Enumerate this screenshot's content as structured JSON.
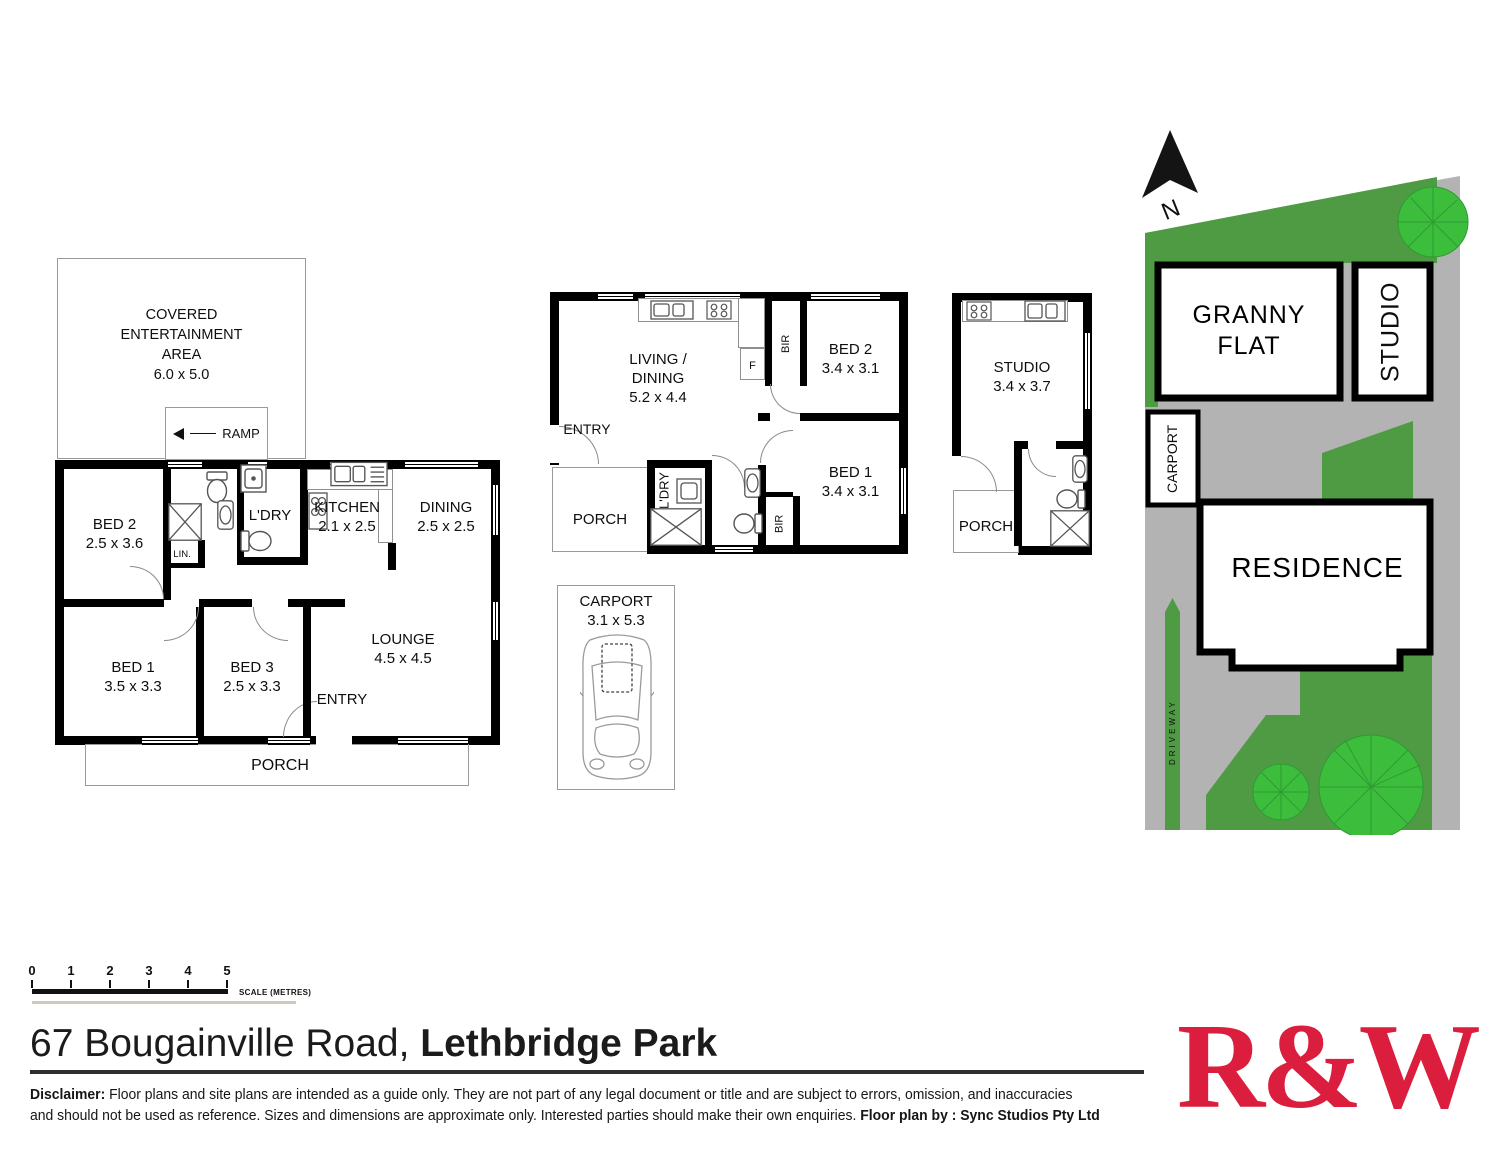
{
  "colors": {
    "wall": "#000000",
    "grass_dark": "#4E9B44",
    "tree_green": "#3CBE3C",
    "paving_gray": "#B3B3B3",
    "logo_red": "#DB1E3D"
  },
  "main_house": {
    "entertainment_area": {
      "line1": "COVERED",
      "line2": "ENTERTAINMENT",
      "line3": "AREA",
      "size": "6.0 x 5.0"
    },
    "ramp_label": "RAMP",
    "bed2": {
      "name": "BED 2",
      "size": "2.5 x 3.6"
    },
    "bed1": {
      "name": "BED 1",
      "size": "3.5 x 3.3"
    },
    "bed3": {
      "name": "BED 3",
      "size": "2.5 x 3.3"
    },
    "kitchen": {
      "name": "KITCHEN",
      "size": "2.1 x 2.5"
    },
    "dining": {
      "name": "DINING",
      "size": "2.5 x 2.5"
    },
    "lounge": {
      "name": "LOUNGE",
      "size": "4.5 x 4.5"
    },
    "ldry_label": "L'DRY",
    "lin_label": "LIN.",
    "entry_label": "ENTRY",
    "porch_label": "PORCH"
  },
  "granny_flat": {
    "living": {
      "line1": "LIVING /",
      "line2": "DINING",
      "size": "5.2 x 4.4"
    },
    "bed2": {
      "name": "BED 2",
      "size": "3.4 x 3.1"
    },
    "bed1": {
      "name": "BED 1",
      "size": "3.4 x 3.1"
    },
    "entry_label": "ENTRY",
    "porch_label": "PORCH",
    "ldry_label": "L'DRY",
    "bir1_label": "BIR",
    "bir2_label": "BIR",
    "fridge_label": "F"
  },
  "carport": {
    "name": "CARPORT",
    "size": "3.1 x 5.3"
  },
  "studio": {
    "name": "STUDIO",
    "size": "3.4 x 3.7",
    "porch_label": "PORCH"
  },
  "site_plan": {
    "north_label": "N",
    "granny_flat": {
      "line1": "GRANNY",
      "line2": "FLAT"
    },
    "studio_label": "STUDIO",
    "carport_label": "CARPORT",
    "residence_label": "RESIDENCE",
    "driveway_label": "DRIVEWAY"
  },
  "scale_bar": {
    "ticks": [
      "0",
      "1",
      "2",
      "3",
      "4",
      "5"
    ],
    "label": "SCALE (METRES)"
  },
  "footer": {
    "address_regular": "67 Bougainville Road, ",
    "address_bold": "Lethbridge Park",
    "disclaimer_bold": "Disclaimer:",
    "disclaimer_line1": " Floor plans and site plans are intended as a guide only. They are not part of any legal document or title and are subject to errors, omission, and inaccuracies",
    "disclaimer_line2": "and should not be used as reference. Sizes and dimensions are approximate only. Interested parties should make their own enquiries. ",
    "floorplan_by": "Floor plan by : Sync Studios Pty Ltd",
    "logo_text": "R&W"
  }
}
